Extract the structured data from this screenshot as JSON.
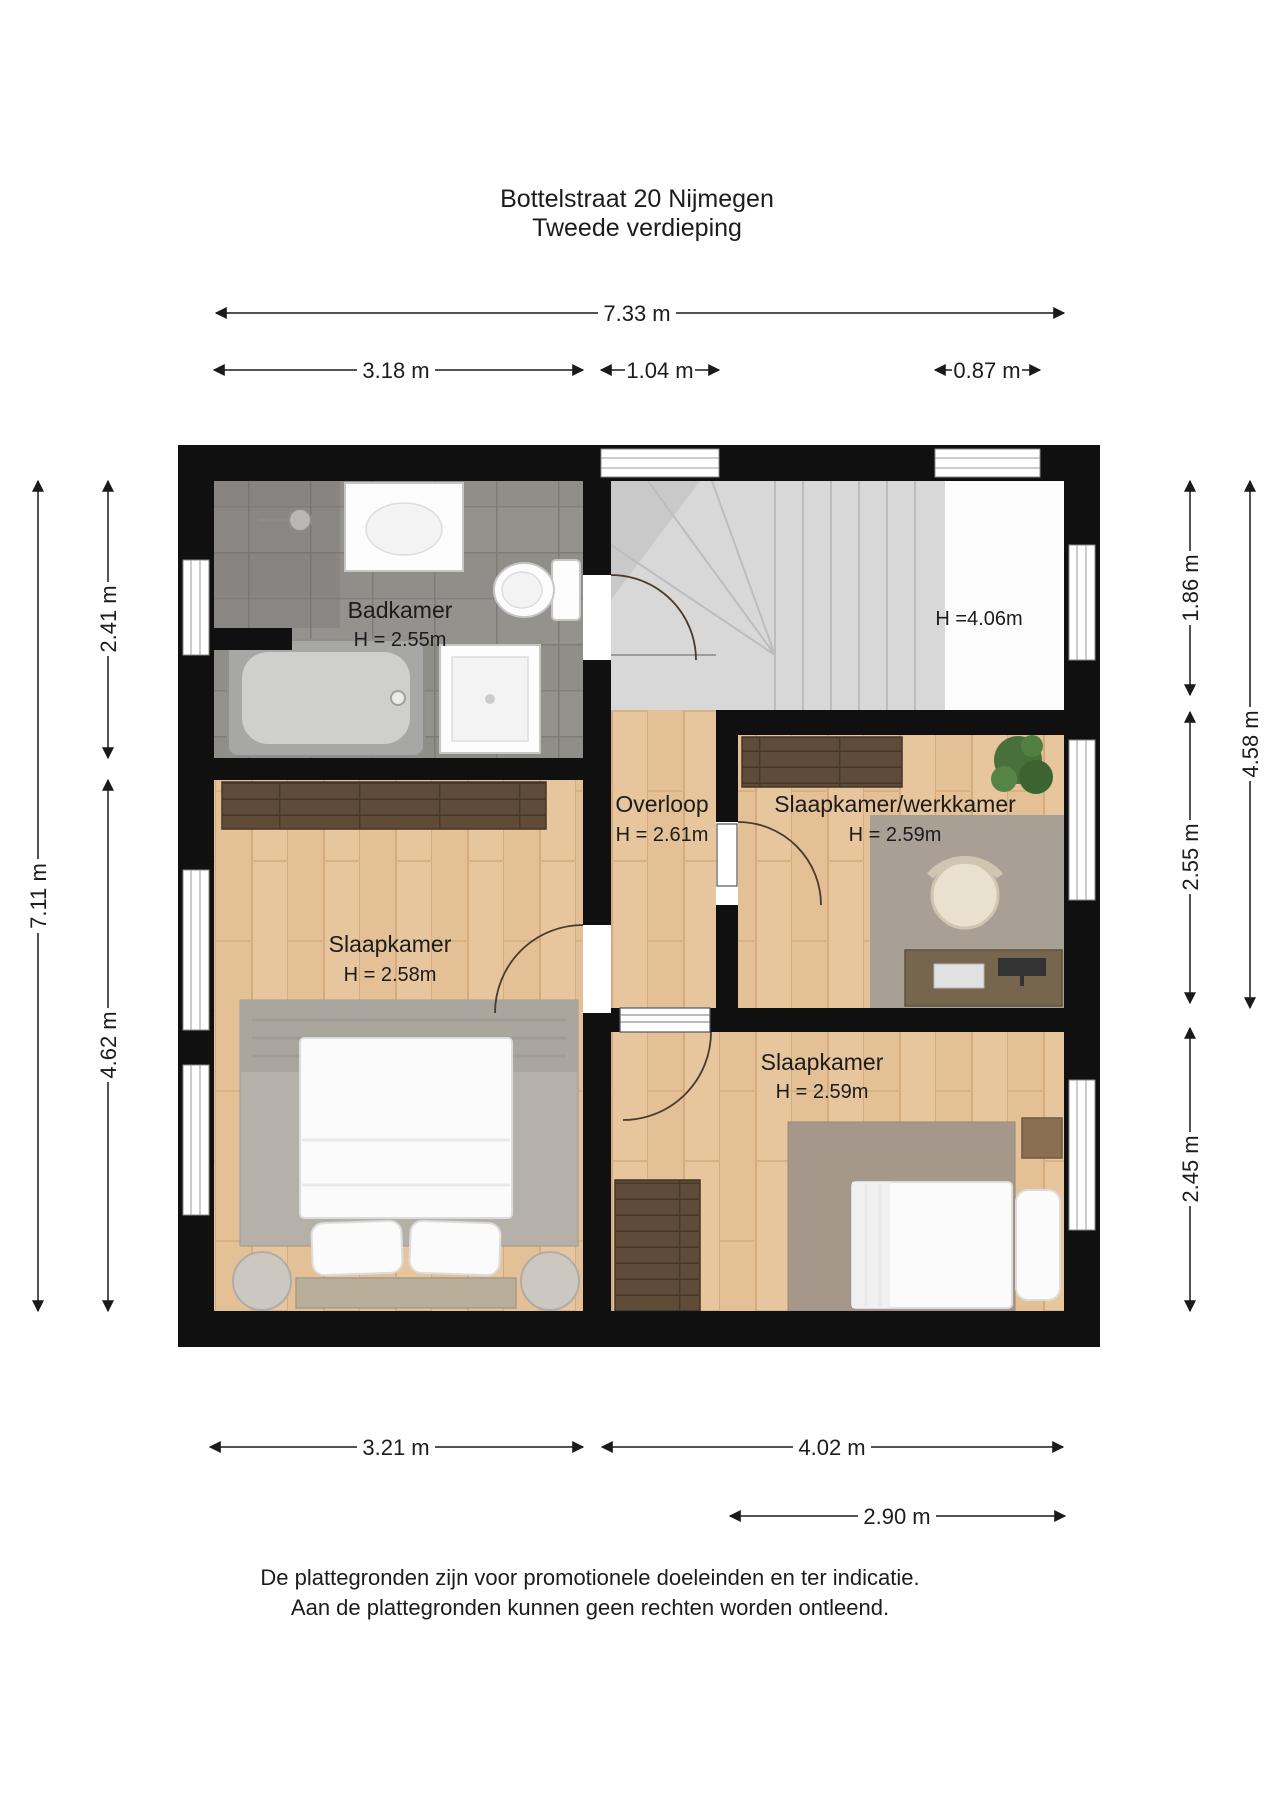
{
  "title": {
    "line1": "Bottelstraat 20 Nijmegen",
    "line2": "Tweede verdieping"
  },
  "rooms": {
    "badkamer": {
      "name": "Badkamer",
      "height": "H = 2.55m"
    },
    "overloop": {
      "name": "Overloop",
      "height": "H = 2.61m"
    },
    "werkkamer": {
      "name": "Slaapkamer/werkkamer",
      "height": "H = 2.59m"
    },
    "slaapkamer_left": {
      "name": "Slaapkamer",
      "height": "H = 2.58m"
    },
    "slaapkamer_rear": {
      "name": "Slaapkamer",
      "height": "H = 2.59m"
    },
    "stairwell": {
      "height": "H =4.06m"
    }
  },
  "dimensions": {
    "top": {
      "total": "7.33 m",
      "badkamer": "3.18 m",
      "hal": "1.04 m",
      "window": "0.87 m"
    },
    "left": {
      "upper": "2.41 m",
      "total": "7.11 m",
      "lower": "4.62 m"
    },
    "right": {
      "stairwell": "1.86 m",
      "outer": "4.58 m",
      "middle": "2.55 m",
      "lower": "2.45 m"
    },
    "bottom": {
      "left": "3.21 m",
      "right": "4.02 m",
      "inner": "2.90 m"
    }
  },
  "disclaimer": {
    "line1": "De plattegronden zijn voor promotionele doeleinden en ter indicatie.",
    "line2": "Aan de plattegronden kunnen geen rechten worden ontleend."
  },
  "colors": {
    "wall": "#101010",
    "wood": "#e7c69e",
    "wood_dark": "#5f4c38",
    "tile": "#908e89",
    "stairs": "#d8d8d8",
    "rug_gray": "#b5b1a9",
    "rug_bedroom": "#a5988a",
    "rug_office": "#a8a094",
    "text": "#1c1c1c"
  }
}
